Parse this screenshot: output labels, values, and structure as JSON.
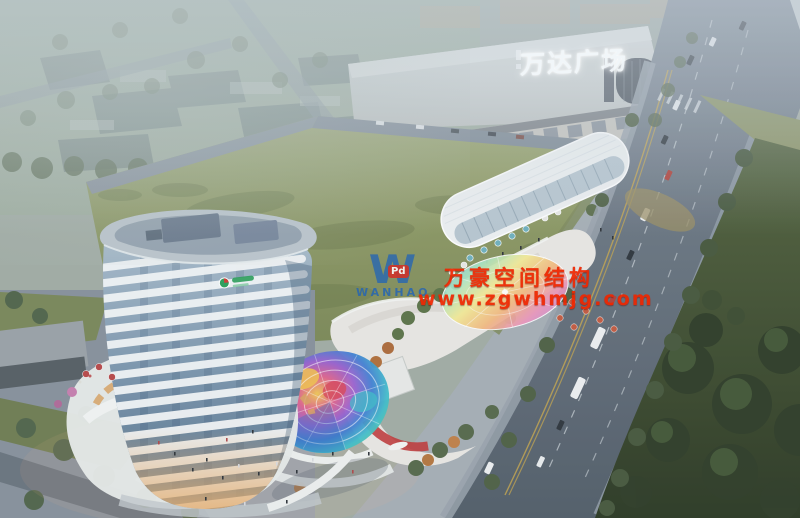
{
  "image": {
    "kind": "architectural aerial rendering at dusk",
    "width": 800,
    "height": 518
  },
  "signs": {
    "mall": "万达广场"
  },
  "watermark": {
    "logo_letter": "W",
    "logo_badge": "Pd",
    "logo_name": "WANHAO",
    "company": "万豪空间结构",
    "website": "www.zgwhmjg.com",
    "text_color": "#ef2600",
    "logo_color": "#2565b4",
    "badge_color": "#d23028"
  },
  "palette": {
    "haze": "#cad4dd",
    "field_green": "#8e9a64",
    "park_green": "#2f3d27",
    "road_gray": "#626d79",
    "tower_white": "#f2f5f6",
    "tower_glass": "#7b95ac",
    "warm_shop_light": "#dca05c",
    "dome_blue": "#3e7ed2",
    "dome_teal": "#3fbecb",
    "dome_pink": "#e2628c",
    "dome_yellow": "#f4c852",
    "mall_wall": "#d3d6d4",
    "umbrella_red": "#b84848",
    "umbrella_teal": "#6fb0bd"
  }
}
